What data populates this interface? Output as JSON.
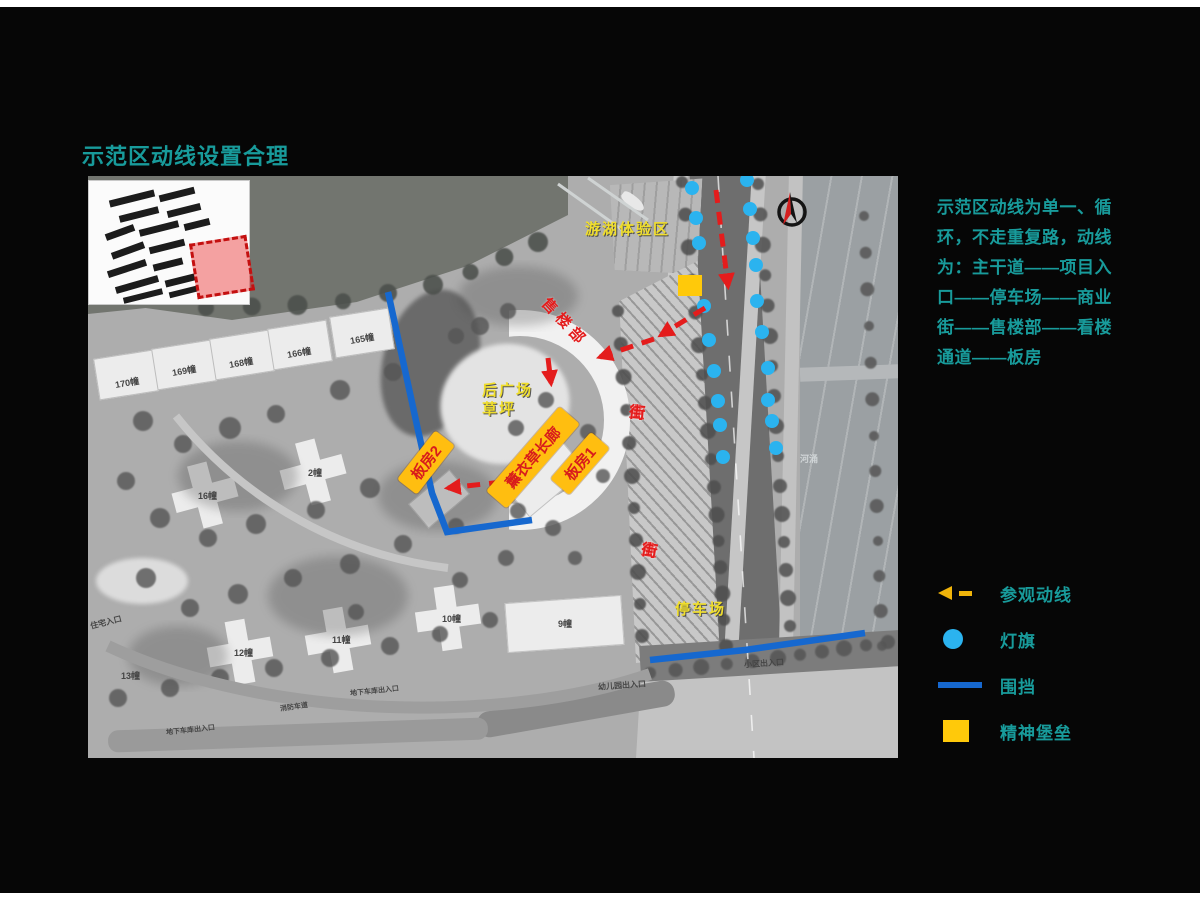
{
  "slide": {
    "title": "示范区动线设置合理",
    "description_lines": [
      "示范区动线为单一、循",
      "环，不走重复路，动线",
      "为：主干道——项目入",
      "口——停车场——商业",
      "街——售楼部——看楼",
      "通道——板房"
    ]
  },
  "legend": {
    "items": [
      {
        "type": "route-arrow",
        "label": "参观动线"
      },
      {
        "type": "light-flag",
        "label": "灯旗"
      },
      {
        "type": "fence",
        "label": "围挡"
      },
      {
        "type": "spirit-fortress",
        "label": "精神堡垒"
      }
    ]
  },
  "colors": {
    "accent_teal": "#189b9b",
    "route_red": "#e41c1c",
    "light_flag_blue": "#2bb3ef",
    "fence_blue": "#1668cf",
    "annotation_yellow": "#ffbe10",
    "legend_arrow_yellow": "#f0b40a",
    "spirit_fortress_yellow": "#ffc90a"
  },
  "map": {
    "zone_labels": [
      {
        "name": "lake-tour-zone-label",
        "text": "游湖体验区",
        "x": 497,
        "y": 45,
        "style": "y",
        "size": 15
      },
      {
        "name": "rear-plaza-lawn-label",
        "text": "后广场\n草坪",
        "x": 394,
        "y": 206,
        "style": "y",
        "size": 15
      },
      {
        "name": "parking-lot-label",
        "text": "停车场",
        "x": 587,
        "y": 425,
        "style": "y",
        "size": 15
      },
      {
        "name": "sales-office-label",
        "text": "售楼部",
        "x": 446,
        "y": 138,
        "style": "r",
        "size": 15,
        "rotate": 47,
        "spacing": 5
      },
      {
        "name": "commercial-street-label-1",
        "text": "商业街",
        "x": 540,
        "y": 228,
        "style": "r vert",
        "size": 16,
        "rotate": 6
      },
      {
        "name": "commercial-street-label-2",
        "text": "商业街",
        "x": 553,
        "y": 366,
        "style": "r vert",
        "size": 16,
        "rotate": 10
      }
    ],
    "signboards": [
      {
        "name": "lavender-corridor-box",
        "text": "薰衣草长廊",
        "cx": 445,
        "cy": 281,
        "w": 112,
        "h": 27,
        "rotate": -49,
        "size": 15
      },
      {
        "name": "model-house-1-box",
        "text": "板房1",
        "cx": 492,
        "cy": 287,
        "w": 62,
        "h": 25,
        "rotate": -49,
        "size": 15
      },
      {
        "name": "model-house-2-box",
        "text": "板房2",
        "cx": 338,
        "cy": 286,
        "w": 62,
        "h": 25,
        "rotate": -52,
        "size": 15
      }
    ],
    "spirit_fortress": {
      "x": 590,
      "y": 99,
      "w": 24,
      "h": 21
    },
    "light_flags": [
      [
        604,
        12
      ],
      [
        608,
        42
      ],
      [
        611,
        67
      ],
      [
        616,
        130
      ],
      [
        621,
        164
      ],
      [
        626,
        195
      ],
      [
        630,
        225
      ],
      [
        632,
        249
      ],
      [
        635,
        281
      ],
      [
        659,
        4
      ],
      [
        662,
        33
      ],
      [
        665,
        62
      ],
      [
        668,
        89
      ],
      [
        669,
        125
      ],
      [
        674,
        156
      ],
      [
        680,
        192
      ],
      [
        680,
        224
      ],
      [
        684,
        245
      ],
      [
        688,
        272
      ]
    ],
    "fences": [
      {
        "points": "300,116 330,254 344,317 359,356 444,344"
      },
      {
        "points": "562,484 657,474 777,457"
      }
    ],
    "route_segments": [
      {
        "d": "M628,14 L640,110"
      },
      {
        "d": "M617,132 L573,159"
      },
      {
        "d": "M566,163 L512,181"
      },
      {
        "d": "M460,182 L463,207"
      },
      {
        "d": "M414,306 L360,312"
      }
    ],
    "compass": {
      "cx": 704,
      "cy": 36,
      "r": 13
    },
    "inset_highlight": {
      "x": 104,
      "y": 58,
      "w": 58,
      "h": 56,
      "rotate": -9
    },
    "base_labels": [
      {
        "text": "170幢",
        "x": 27,
        "y": 200,
        "size": 9,
        "rot": -10
      },
      {
        "text": "169幢",
        "x": 84,
        "y": 188,
        "size": 9,
        "rot": -10
      },
      {
        "text": "168幢",
        "x": 141,
        "y": 180,
        "size": 9,
        "rot": -10
      },
      {
        "text": "166幢",
        "x": 199,
        "y": 170,
        "size": 9,
        "rot": -10
      },
      {
        "text": "165幢",
        "x": 262,
        "y": 156,
        "size": 9,
        "rot": -10
      },
      {
        "text": "16幢",
        "x": 110,
        "y": 313,
        "size": 9,
        "rot": 0
      },
      {
        "text": "2幢",
        "x": 220,
        "y": 290,
        "size": 9,
        "rot": 0
      },
      {
        "text": "13幢",
        "x": 33,
        "y": 493,
        "size": 9,
        "rot": 0
      },
      {
        "text": "12幢",
        "x": 146,
        "y": 470,
        "size": 9,
        "rot": 0
      },
      {
        "text": "11幢",
        "x": 244,
        "y": 457,
        "size": 9,
        "rot": 0
      },
      {
        "text": "10幢",
        "x": 354,
        "y": 436,
        "size": 9,
        "rot": 0
      },
      {
        "text": "9幢",
        "x": 470,
        "y": 441,
        "size": 9,
        "rot": 0
      },
      {
        "text": "住宅入口",
        "x": 2,
        "y": 441,
        "size": 8,
        "rot": -14
      },
      {
        "text": "地下车库出入口",
        "x": 78,
        "y": 549,
        "size": 7,
        "rot": -6
      },
      {
        "text": "地下车库出入口",
        "x": 262,
        "y": 510,
        "size": 7,
        "rot": -6
      },
      {
        "text": "消防车道",
        "x": 192,
        "y": 526,
        "size": 7,
        "rot": -8
      },
      {
        "text": "幼儿园出入口",
        "x": 510,
        "y": 504,
        "size": 8,
        "rot": -4
      },
      {
        "text": "小区出入口",
        "x": 656,
        "y": 482,
        "size": 8,
        "rot": -4
      },
      {
        "text": "河涌",
        "x": 712,
        "y": 276,
        "size": 9,
        "rot": 0,
        "light": true
      }
    ]
  }
}
